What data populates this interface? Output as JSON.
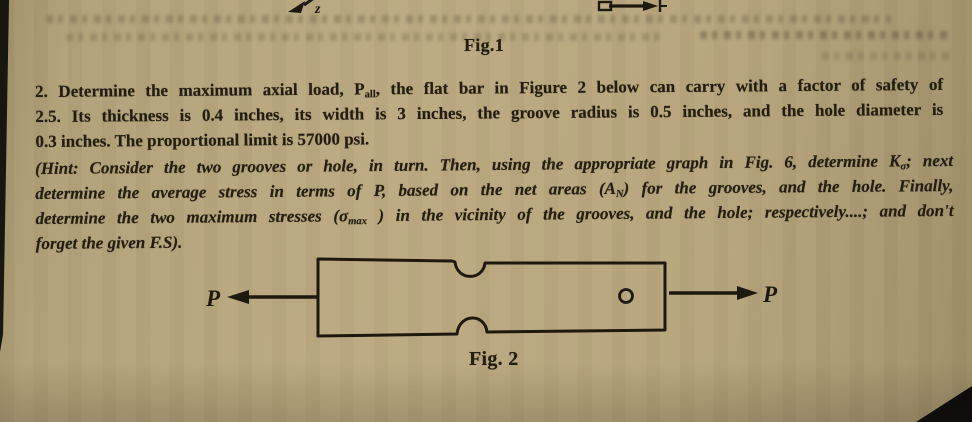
{
  "document": {
    "fig1_caption": "Fig.1",
    "fig2_caption": "Fig. 2"
  },
  "problem": {
    "line1": {
      "pre": "2. Determine the maximum axial load, P",
      "sub": "all",
      "post": ", the flat bar in Figure 2 below can carry with a factor of safety of"
    },
    "line2": "2.5. Its thickness is 0.4 inches, its width is 3 inches, the groove radius is 0.5 inches, and the hole diameter is",
    "line3": "0.3 inches. The proportional limit is 57000 psi."
  },
  "hint": {
    "line1": {
      "pre": "(Hint: Consider the two grooves or hole, in turn. Then, using the appropriate graph in Fig. 6, determine K",
      "sub": "σ",
      "post": "; next"
    },
    "line2": {
      "pre": "determine the average stress in terms of P, based on the net areas (A",
      "sub": "N",
      "post": ") for the grooves, and the hole. Finally,"
    },
    "line3": {
      "pre": "determine the two maximum stresses (σ",
      "sub": "max",
      "post": " ) in the vicinity of the grooves, and the hole; respectively....; and don't"
    },
    "line4": "forget the given F.S)."
  },
  "figure2": {
    "left_load_label": "P",
    "right_load_label": "P"
  },
  "fig1_remnant": {
    "axis_label": "z"
  },
  "colors": {
    "paper": "#b5a57c",
    "ink": "#241e12"
  }
}
